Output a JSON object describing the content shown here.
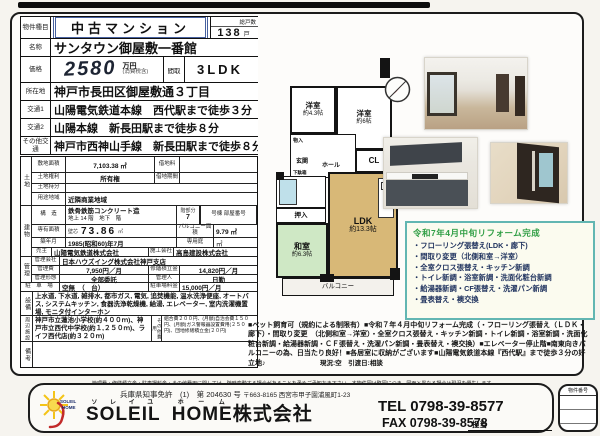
{
  "colors": {
    "accent_blue": "#46609f",
    "reform_border": "#62b6b2",
    "reform_title": "#2f9e44",
    "washitsu_green": "#cfe8c5",
    "ldk_tan": "#d8b877",
    "tub_blue": "#bfe0ea"
  },
  "top": {
    "type_label": "物件種目",
    "type_value": "中古マンション",
    "units_label": "総戸数",
    "units_value": "138",
    "units_suffix": "戸",
    "name_label": "名称",
    "name_value": "サンタウン御屋敷一番館",
    "price_label": "価格",
    "price_value": "2580",
    "price_unit": "万円",
    "price_tax": "(消費税含)",
    "layout_label": "間取",
    "layout_value": "3LDK",
    "addr_label": "所在地",
    "addr_value": "神戸市長田区御屋敷通３丁目",
    "access1_label": "交通1",
    "access1_value": "山陽電気鉄道本線　西代駅まで徒歩３分",
    "access2_label": "交通2",
    "access2_value": "山陽本線　新長田駅まで徒歩８分",
    "access3_label": "その他交通",
    "access3_value": "神戸市西神山手線　新長田駅まで徒歩８分"
  },
  "land": {
    "group_label": "土地",
    "area_label": "敷地面積",
    "area_value": "7,103.38 ㎡",
    "rent_label": "借地料",
    "rent_value": "",
    "right_label": "土地権利",
    "right_value": "所有権",
    "term_label": "借地期間",
    "term_value": "",
    "share_label": "土地持分",
    "share_value": "",
    "zone_label": "用途地域",
    "zone_value": "近隣商業地域"
  },
  "building": {
    "group_label": "建物",
    "structure_label": "構　造",
    "structure_value": "鉄骨鉄筋コンクリート造",
    "floors_value": "地上 14 階　地下　階",
    "floor_part_label": "階部分",
    "floor_part_value": "7",
    "unit_no_label": "号棟 部屋番号",
    "area_label": "専有面積",
    "area_type": "壁芯",
    "area_value": "73.86",
    "area_unit": "㎡",
    "balcony_label": "バルコニー面積",
    "balcony_value": "9.79 ㎡",
    "built_label": "築年月",
    "built_value": "1985(昭和60)年7月",
    "garden_label": "専用庭",
    "garden_value": "㎡",
    "seller_label": "売主",
    "seller_value": "山陽電気鉄道株式会社",
    "builder_label": "施工会社",
    "builder_value": "高島建設株式会社"
  },
  "management": {
    "group_label": "管理",
    "company_label": "管理会社",
    "company_value": "日本ハウズイング株式会社神戸支店",
    "fee_label": "管理費",
    "fee_value": "7,950円／月",
    "reserve_label": "修繕積立金",
    "reserve_value": "14,820円／月",
    "style_label": "管理形態",
    "style_value": "全部委託",
    "manager_label": "管理人",
    "manager_value": "日勤"
  },
  "parking": {
    "label": "駐 車 場",
    "value": "空無　（　台）",
    "fee_label": "駐車場料金",
    "fee_value": "15,000円／月"
  },
  "equipment": {
    "label": "設備",
    "value": "上水道, 下水道, 雑排水, 都市ガス, 電気, 追焚機能, 温水洗浄便座, オートバス, システムキッチン, 食器洗浄乾燥機, 給湯, エレベーター, 室内洗濯機置場, モニタ付インターホン"
  },
  "surroundings": {
    "label": "周辺施設",
    "value": "神戸市立蓮池小学校(約４００ｍ)、神戸市立西代中学校(約１,２５０ｍ)、ライフ西代店(約３２０ｍ)",
    "other_label": "その他費用",
    "other_value": "組合費２００円、(月額)自治会費１５０円、(月額)ガス警報器設置費用(２５０円)、団地修繕積立金(２０円)"
  },
  "remarks": {
    "label": "備考",
    "value": ""
  },
  "floor_plan": {
    "yoshitsu1_name": "洋室",
    "yoshitsu1_size": "約4.3帖",
    "yoshitsu2_name": "洋室",
    "yoshitsu2_size": "約6帖",
    "closet": "CL",
    "monoire1": "物入",
    "monoire2": "物入",
    "genkan": "玄関",
    "hall": "ホール",
    "getabako": "下駄箱",
    "pantry": "食品庫",
    "oshiire": "押入",
    "washitsu_name": "和室",
    "washitsu_size": "約6.3帖",
    "ldk_name": "LDK",
    "ldk_size": "約13.3帖",
    "balcony": "バルコニー"
  },
  "reform": {
    "title": "令和7年4月中旬リフォーム完成",
    "items": [
      "・フローリング張替え(LDK・廊下)",
      "・間取り変更（北側和室→洋室）",
      "・全室クロス張替え・キッチン新調",
      "・トイレ新調・浴室新調・洗面化粧台新調",
      "・給湯器新調・CF張替え・洗濯パン新調",
      "・畳表替え・襖交換"
    ]
  },
  "pr": {
    "text": "■ペット飼育可（規約による制限有）■令和７年４月中旬リフォーム完成（・フローリング張替え（ＬＤＫ・廊下）・間取り変更　（北側和室→洋室）・全室クロス張替え・キッチン新調・トイレ新調・浴室新調・洗面化粧台新調・給湯器新調・ＣＦ張替え・洗濯パン新調・畳表替え・襖交換）■エレベーター停止階■南東向きバルコニーの為、日当たり良好！■各居室に収納がございます■山陽電気鉄道本線『西代駅』まで徒歩３分の好立地♪",
    "status": "現況:空　引渡日:相談",
    "note": "管理費・修繕積立金・駐車場料金・その他費用に関しては、随時変動する場合があることを予めご承知おき下さい。本物件図は略図につき、図面と異なる場合は現況を優先します。"
  },
  "footer": {
    "license": "兵庫県知事免許　(1)　第 204630 号",
    "address": "〒663-8165 西宮市甲子園浦風町1-23",
    "ruby_soleil": "ソレイユ",
    "ruby_home": "ホーム",
    "company_en1": "SOLEIL",
    "company_en2": "HOME",
    "company_suffix": "株式会社",
    "tel": "TEL 0798-39-8577",
    "fax": "FAX 0798-39-8578",
    "staff_label": "担当",
    "property_no_label": "物件番号"
  }
}
